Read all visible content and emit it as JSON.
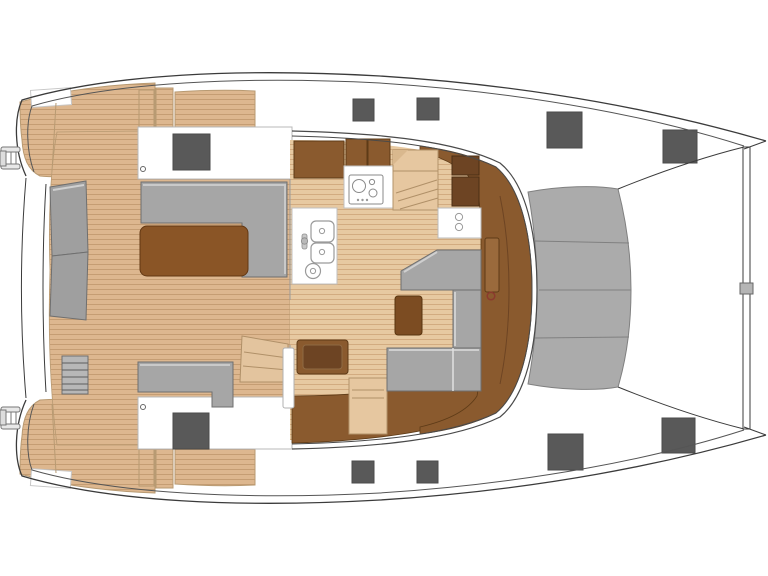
{
  "diagram": {
    "kind": "catamaran-deck-plan",
    "view": "top-down",
    "orientation": "bow-right"
  },
  "colors": {
    "background": "#ffffff",
    "outline_dark": "#3b3b3b",
    "outline_mid": "#555555",
    "outline_light": "#b0b0b0",
    "teak_deck": "#ddb78f",
    "teak_plank_line": "#c59d73",
    "interior_floor": "#e7c9a1",
    "interior_plank_line": "#d2ab80",
    "seat_gray": "#a6a6a6",
    "seat_gray_edge": "#6f6f6f",
    "seat_gray_bevel": "#d0d0d0",
    "transom_bench_gray": "#9f9f9f",
    "step_gray": "#b7b7b7",
    "trampoline_gray": "#ababab",
    "trampoline_edge": "#808080",
    "furniture_brown": "#8a5a2e",
    "furniture_brown_edge": "#5e3b17",
    "furniture_brown_dark": "#6d4423",
    "door_brown": "#9a6a3c",
    "table_brown": "#8a5526",
    "table_brown_edge": "#633813",
    "small_table_brown": "#7c4c22",
    "bench_tan": "#e6c7a0",
    "bench_tan_edge": "#b3936a",
    "hatch_gray": "#595959",
    "hatch_edge": "#4a4a4a",
    "white": "#ffffff",
    "fitting_gray": "#b5b5b5",
    "knob_red": "#8b3a2e"
  },
  "hatches": [
    {
      "x": 173,
      "y": 134,
      "w": 37,
      "h": 36
    },
    {
      "x": 353,
      "y": 99,
      "w": 21,
      "h": 22
    },
    {
      "x": 417,
      "y": 98,
      "w": 22,
      "h": 22
    },
    {
      "x": 547,
      "y": 112,
      "w": 35,
      "h": 36
    },
    {
      "x": 663,
      "y": 130,
      "w": 34,
      "h": 33
    },
    {
      "x": 173,
      "y": 413,
      "w": 36,
      "h": 36
    },
    {
      "x": 352,
      "y": 461,
      "w": 22,
      "h": 22
    },
    {
      "x": 417,
      "y": 461,
      "w": 21,
      "h": 22
    },
    {
      "x": 548,
      "y": 434,
      "w": 35,
      "h": 36
    },
    {
      "x": 662,
      "y": 418,
      "w": 33,
      "h": 35
    }
  ],
  "counts": {
    "deck_hatches": 10,
    "trampoline_panels": 4,
    "stove_burners": 3,
    "sink_basins": 2,
    "cockpit_tables": 1,
    "saloon_tables": 1
  }
}
